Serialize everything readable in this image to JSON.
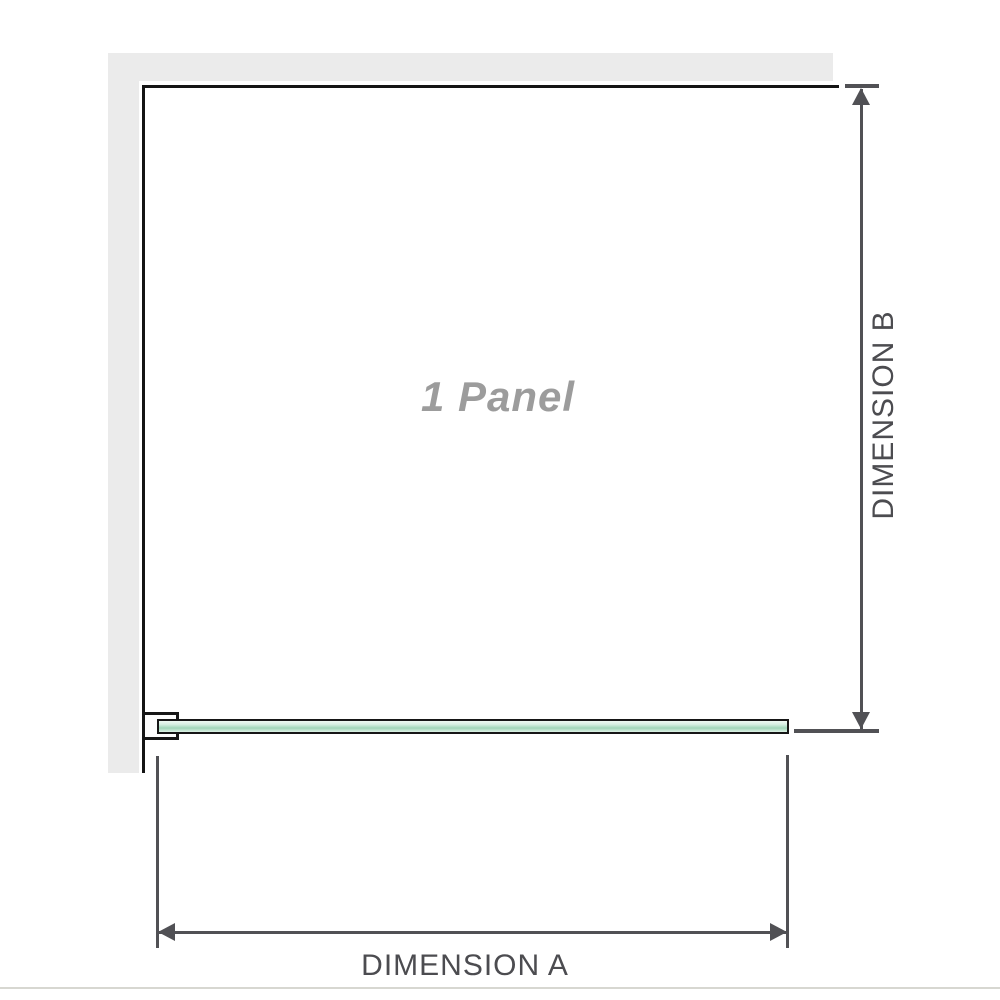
{
  "diagram": {
    "panel_label": "1 Panel",
    "dimension_a": {
      "label": "DIMENSION A",
      "orientation": "horizontal"
    },
    "dimension_b": {
      "label": "DIMENSION B",
      "orientation": "vertical"
    }
  },
  "icons": {
    "dimension_b_start": "arrow-up-icon",
    "dimension_b_end": "arrow-down-icon",
    "dimension_a_start": "arrow-left-icon",
    "dimension_a_end": "arrow-right-icon"
  },
  "colors": {
    "wall_gray": "#ebebeb",
    "frame_black": "#141414",
    "glass_green_light": "#eef8f2",
    "glass_green": "#a0d5b8",
    "glass_border": "#161616",
    "dimension_line_gray": "#515155",
    "dimension_text_gray": "#4c4c50",
    "panel_label_gray": "#9c9c9c",
    "baseline_gray": "#d7d7d1",
    "background": "#ffffff"
  }
}
